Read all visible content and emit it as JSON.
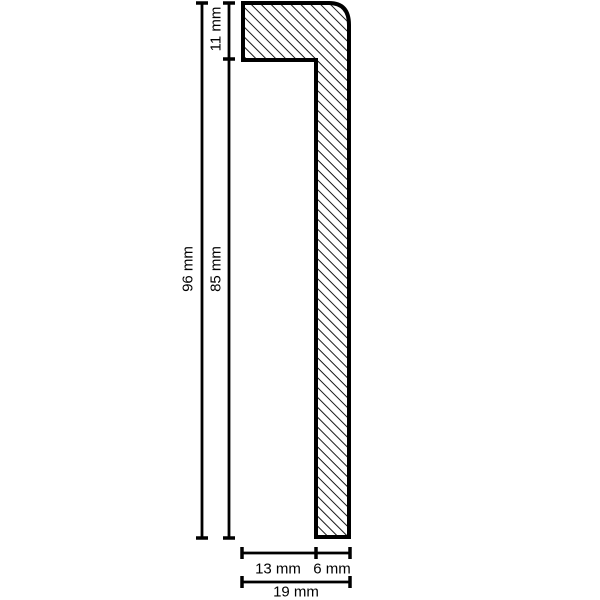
{
  "diagram": {
    "type": "technical-profile-cross-section",
    "dimensions": {
      "upper_height": "11 mm",
      "total_height": "96 mm",
      "lower_height": "85 mm",
      "bottom_left_width": "13 mm",
      "bottom_right_width": "6 mm",
      "total_width": "19 mm"
    },
    "colors": {
      "line": "#000000",
      "background": "#ffffff"
    }
  }
}
